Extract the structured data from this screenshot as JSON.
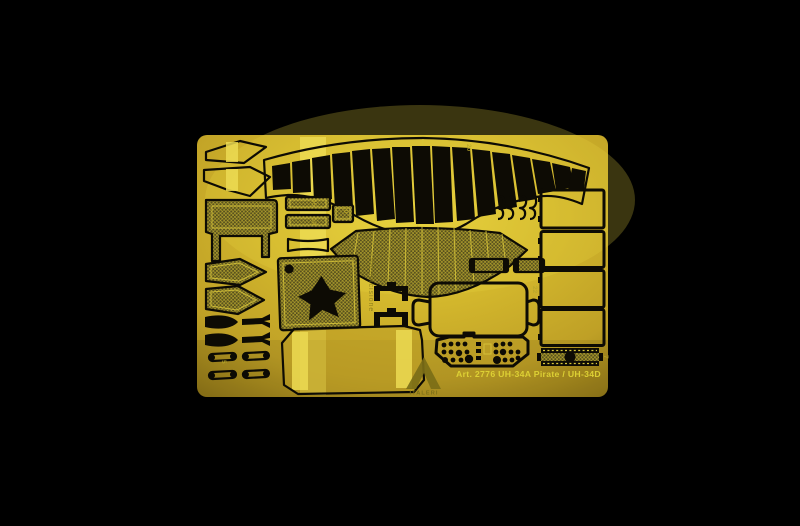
{
  "fret": {
    "label": "Art. 2776 UH-34A Pirate / UH-34D",
    "brand": "ITALERI",
    "vertical_text": "Fotoincisione",
    "etched_numbers": {
      "n1": "20",
      "n2": "10",
      "n3": "1",
      "n4": "45",
      "n5": "14",
      "n6": "22",
      "n7": "5",
      "n8": "7"
    }
  },
  "colors": {
    "background": "#000000",
    "brass_bright": "#e9d33f",
    "brass_mid": "#d2b62c",
    "brass_deep": "#bfa026",
    "brass_edge": "#917718",
    "etch_black": "#0d0b04",
    "mesh_dark": "#57501d",
    "mesh_line": "#b3a22e",
    "highlight_band": "#ecdb52",
    "inner_line": "#d8c63a",
    "logo_olive": "#7b6e17",
    "label_text": "#ddd034",
    "faint_text": "#b8a62a"
  }
}
